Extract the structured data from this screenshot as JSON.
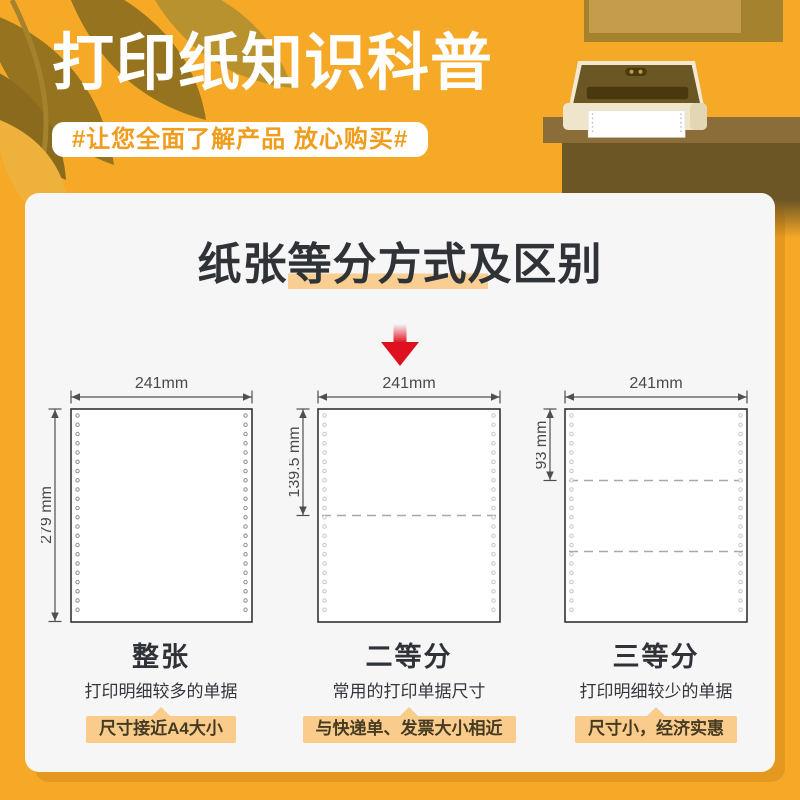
{
  "header": {
    "title": "打印纸知识科普",
    "subtitle": "#让您全面了解产品 放心购买#"
  },
  "card": {
    "title_pre": "纸张",
    "title_mid": "等分方式",
    "title_suf": "及区别"
  },
  "columns": [
    {
      "top_dim": "241mm",
      "side_dim": "279 mm",
      "name": "整张",
      "desc": "打印明细较多的单据",
      "tag": "尺寸接近A4大小"
    },
    {
      "top_dim": "241mm",
      "side_dim": "139.5 mm",
      "name": "二等分",
      "desc": "常用的打印单据尺寸",
      "tag": "与快递单、发票大小相近"
    },
    {
      "top_dim": "241mm",
      "side_dim": "93 mm",
      "name": "三等分",
      "desc": "打印明细较少的单据",
      "tag": "尺寸小，经济实惠"
    }
  ],
  "icons": {
    "down_arrow": "red gradient arrow pointing down",
    "leaves": "olive leaf decoration",
    "printer": "dot-matrix printer on desk illustration"
  },
  "colors": {
    "background_orange": "#F6A827",
    "card_background": "#F6F6F7",
    "tag_background": "#FACC8C",
    "title_highlight": "#F8CE92",
    "arrow_red": "#E0111F",
    "pill_text_orange": "#F09C1C",
    "desk_brown": "#6D5626",
    "leaf_olive": "#96731F"
  }
}
